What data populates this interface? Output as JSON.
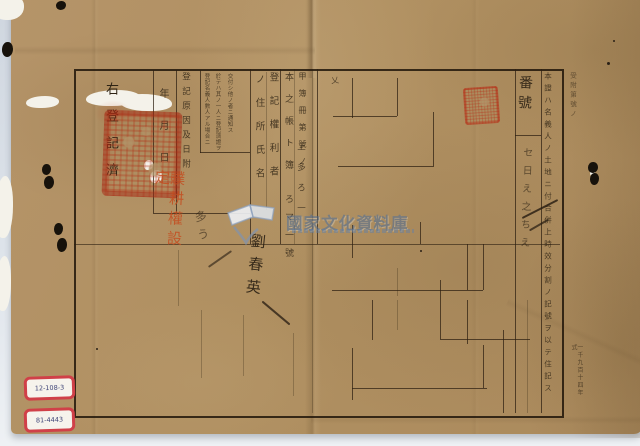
{
  "watermark": {
    "text": "國家文化資料庫",
    "icon": "open-book",
    "color": "#4a6d9c"
  },
  "certificate": {
    "statement": "右登記濟",
    "date_column": "年月日",
    "cause_column": "登記原因及日附",
    "note_lines": [
      "登記名義人數人アル場合ニ",
      "於テハ其ノ一人ニ登記濟證ヲ",
      "交付シ他ノ者ニ通知ス"
    ],
    "holder_column_right": "登記權利者",
    "holder_column_left": "ノ住所氏名",
    "ledger_column": "本之帳ト簿",
    "book_number_column": "甲簿冊第號ノ",
    "tenancy_stamp": "贌耕權設定",
    "cell_header": "番號",
    "side_note_column": "本證ハ名義人ノ土地ニ付合併上時效分割ノ記號ヲ以テ住記ス",
    "margin_top_right": "受附第號ノ",
    "margin_bottom_right": "一千九百十四年式"
  },
  "handwriting": {
    "cell_entries": "セ日え之ちえ",
    "column_marks": "上多ろ一",
    "number_marks": "ろマ一號",
    "signature": "劉春英",
    "scribble": "多う",
    "check_mark": "乂"
  },
  "archive_labels": [
    {
      "text": "12-108-3"
    },
    {
      "text": "81-4443"
    }
  ],
  "colors": {
    "paper": "#b29469",
    "ink": "#2b2014",
    "seal_red": "#b23a1e",
    "stamp_orange": "#c44f22",
    "watermark_blue": "#4a6d9c",
    "scan_background": "#dde3ea",
    "label_border": "#d04048"
  }
}
